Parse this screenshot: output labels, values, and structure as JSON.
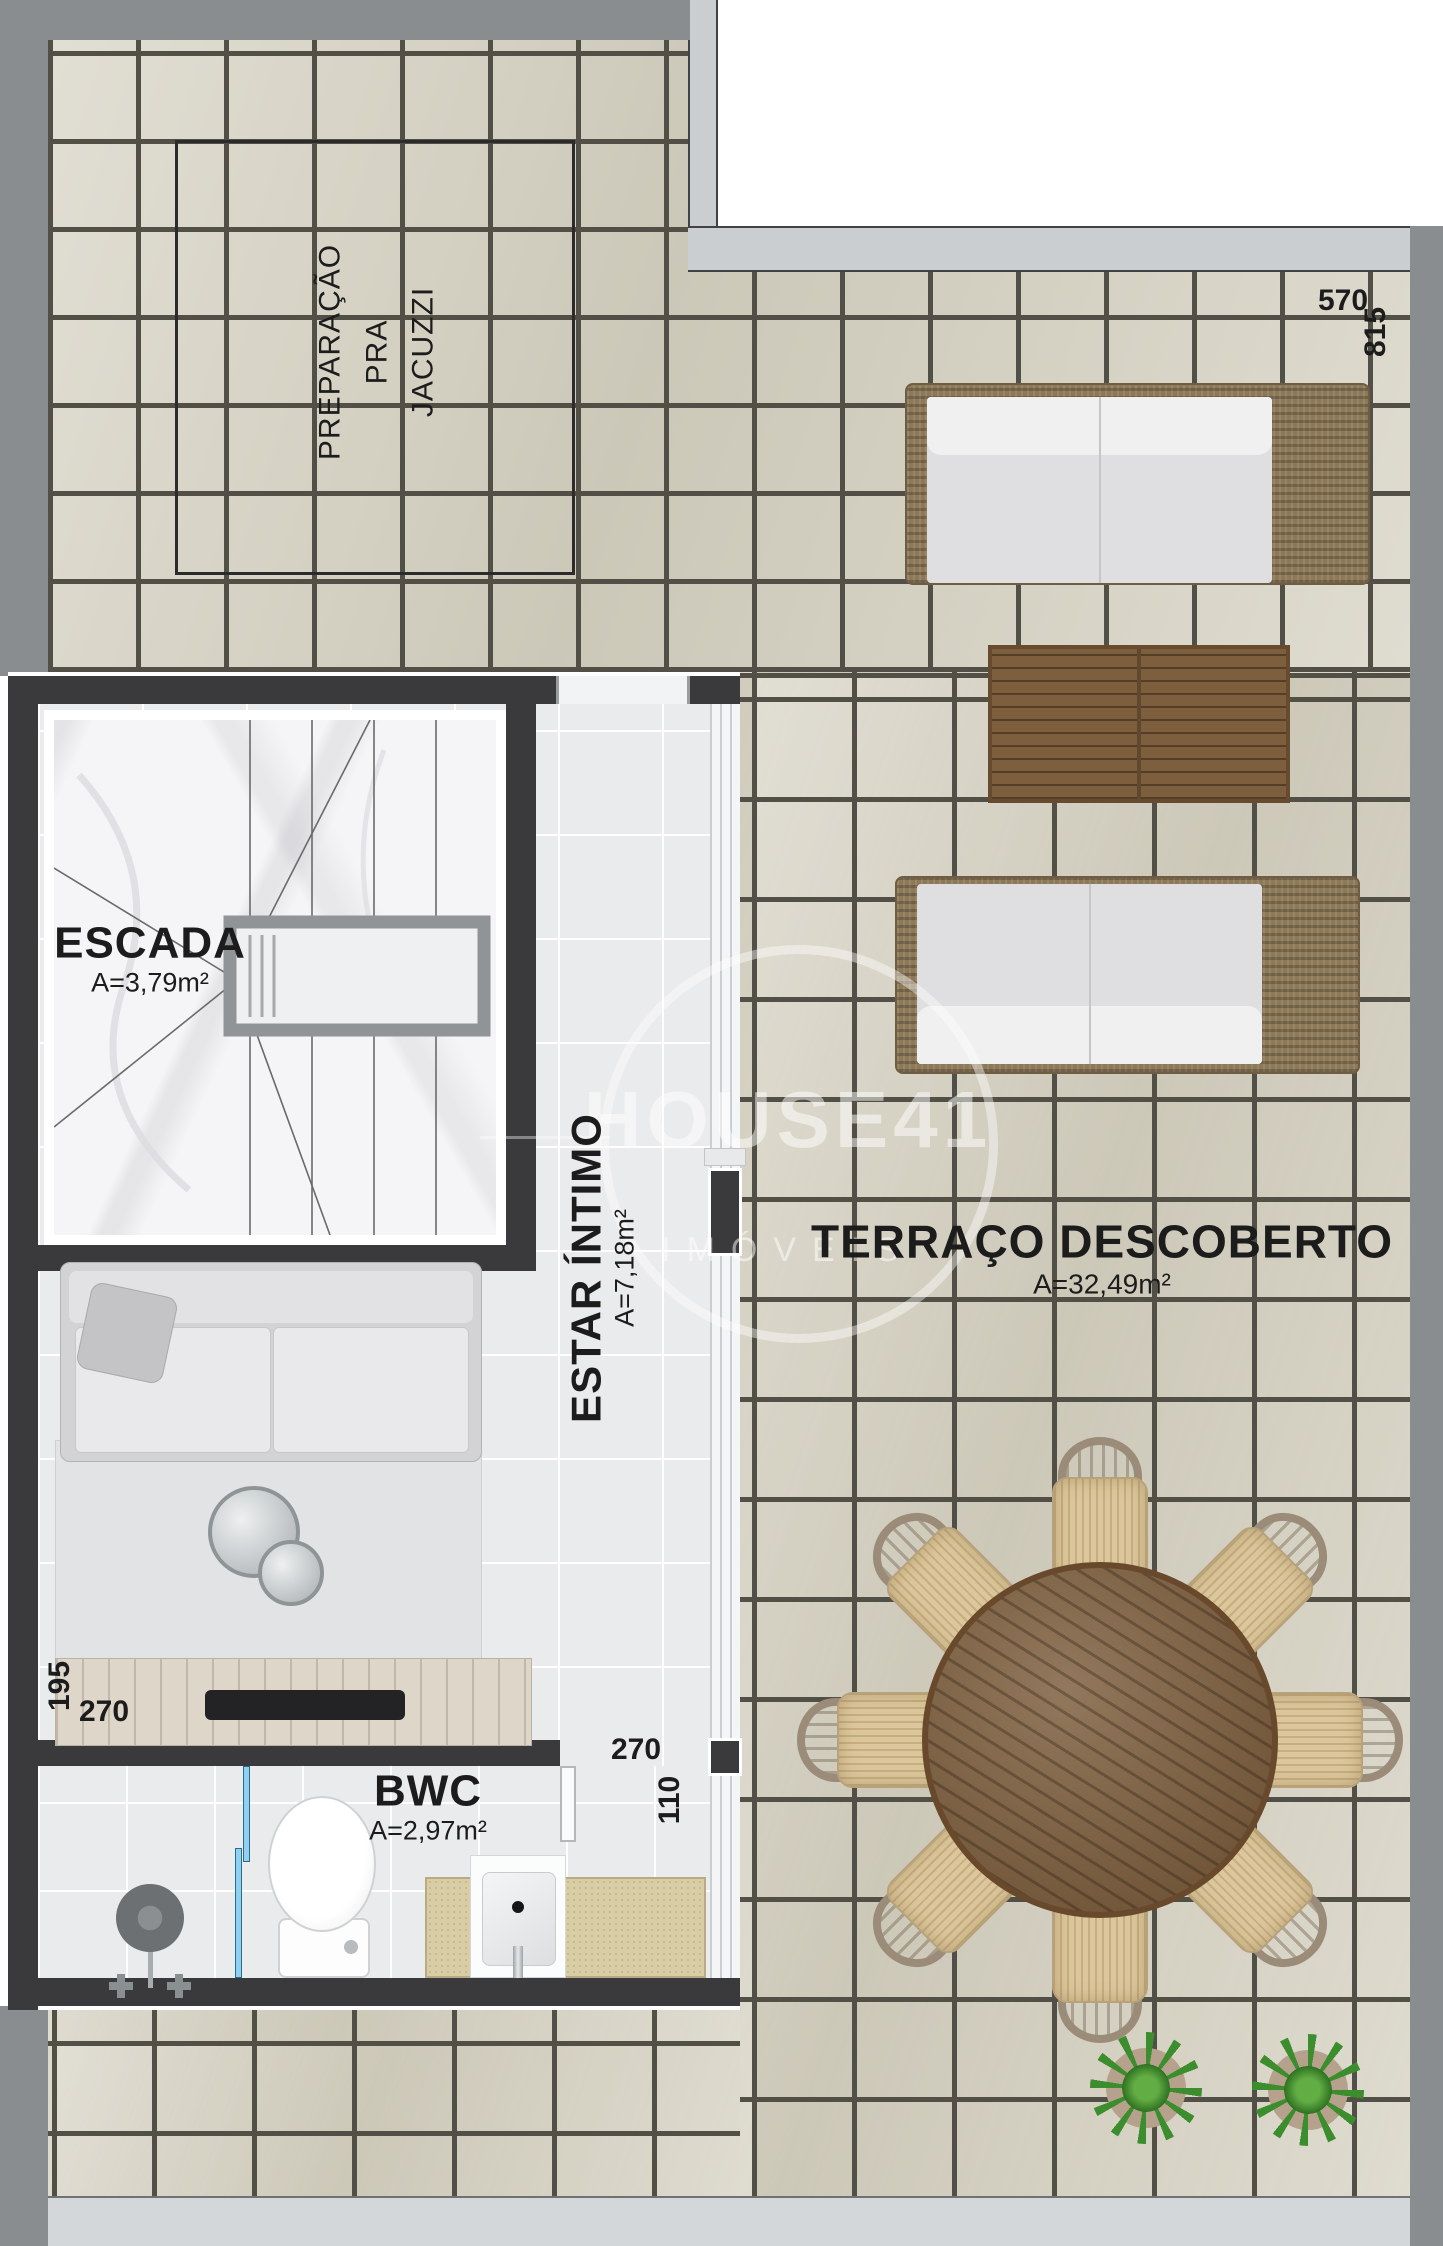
{
  "plan": {
    "rooms": {
      "escada": {
        "name": "ESCADA",
        "area": "A=3,79m²"
      },
      "estar": {
        "name": "ESTAR ÍNTIMO",
        "area": "A=7,18m²"
      },
      "terraco": {
        "name": "TERRAÇO DESCOBERTO",
        "area": "A=32,49m²"
      },
      "bwc": {
        "name": "BWC",
        "area": "A=2,97m²"
      }
    },
    "notes": {
      "jacuzzi": "PREPARAÇÃO\nPRA\nJACUZZI"
    },
    "dimensions": {
      "top_width": "570",
      "top_height": "815",
      "sideboard_depth": "195",
      "sideboard_width": "270",
      "estar_width": "270",
      "door_width": "110"
    }
  },
  "watermark": {
    "brand": "HOUSE41",
    "sub": "IMÓVEIS"
  },
  "colors": {
    "wall": "#3a3a3c",
    "band": "#8a8d8f",
    "parapet": "#cbced0",
    "bottomStrip": "#d4d7da",
    "tile": "#d6d2c3",
    "grout": "#525046",
    "floor": "#eaebed",
    "marble": "#f5f5f7",
    "wood_dark": "#7a5a38",
    "wood_mid": "#7d5e3d",
    "wicker": "#8d7857",
    "cushion": "#e4e4e6",
    "counter": "#d9cda5",
    "glass": "#8ed1f0",
    "seat": "#dcc79c",
    "chairback": "#9b8c79",
    "plant": "#3c8d2e",
    "rug": "#e2e3e5",
    "sofa_gray": "#d3d3d5",
    "sideboard": "#ddd6c9",
    "ink": "#1c1c1c",
    "void": "#eef0f1"
  }
}
